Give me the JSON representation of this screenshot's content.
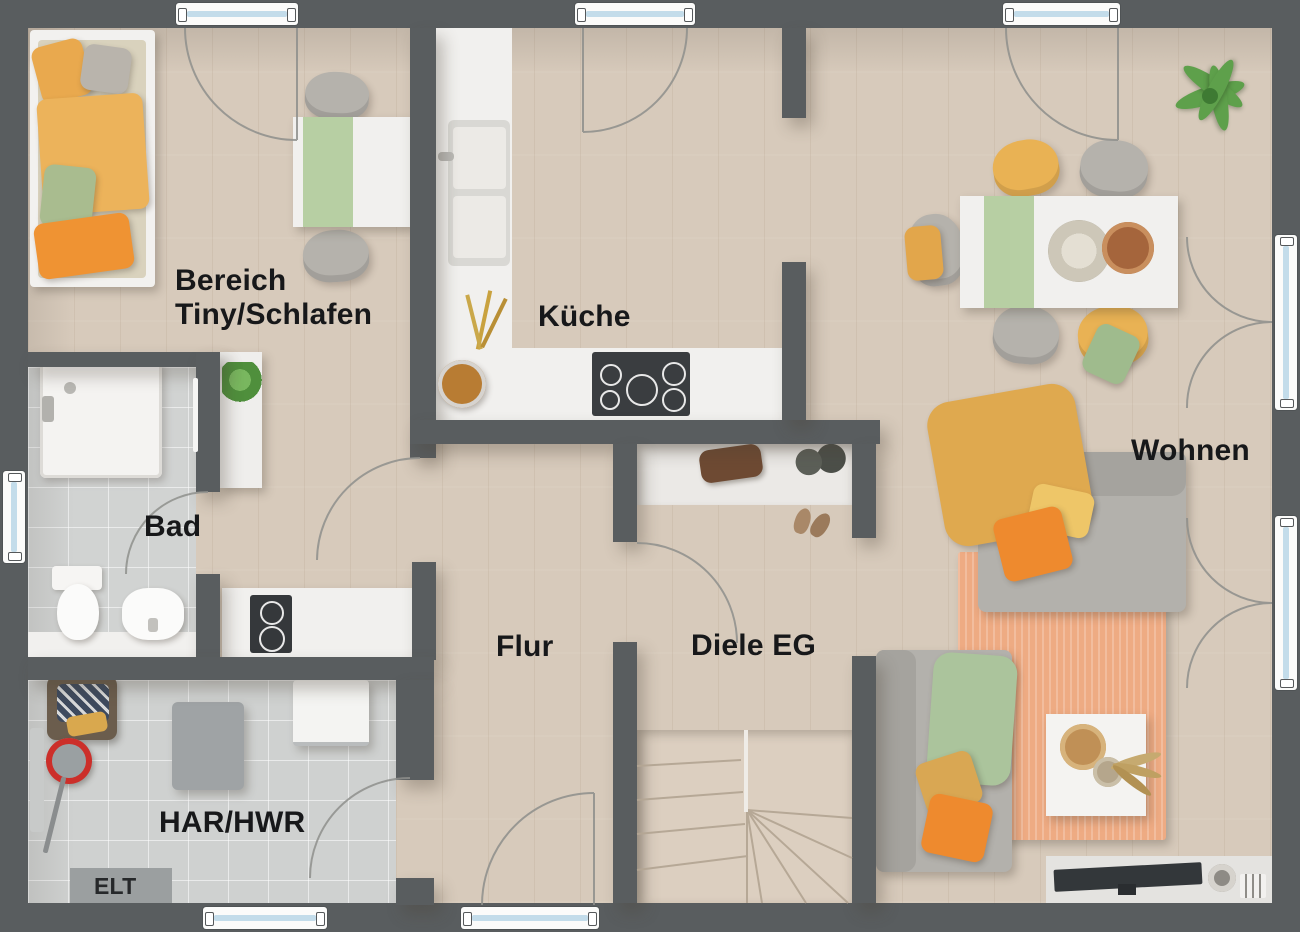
{
  "labels": {
    "tiny_line1": "Bereich",
    "tiny_line2": "Tiny/Schlafen",
    "kitchen": "Küche",
    "living": "Wohnen",
    "bath": "Bad",
    "hallway": "Flur",
    "foyer": "Diele EG",
    "utility": "HAR/HWR",
    "electrical": "ELT"
  },
  "colors": {
    "wall": "#595d5f",
    "wood_floor": "#d7cabb",
    "tile_floor": "#cfd1d0",
    "niche_floor": "#ebe9e6",
    "window_glass": "#c3dcea",
    "counter_white": "#f1f0ee",
    "cooktop_black": "#3a3d40",
    "sofa_gray": "#b3b1ac",
    "rug_salmon": "#eeab83",
    "accent_orange": "#ee8a2e",
    "accent_mustard": "#e5ab55",
    "accent_green": "#abc49c",
    "plant_green": "#5ea04b",
    "bucket_red": "#cc2f2a"
  }
}
